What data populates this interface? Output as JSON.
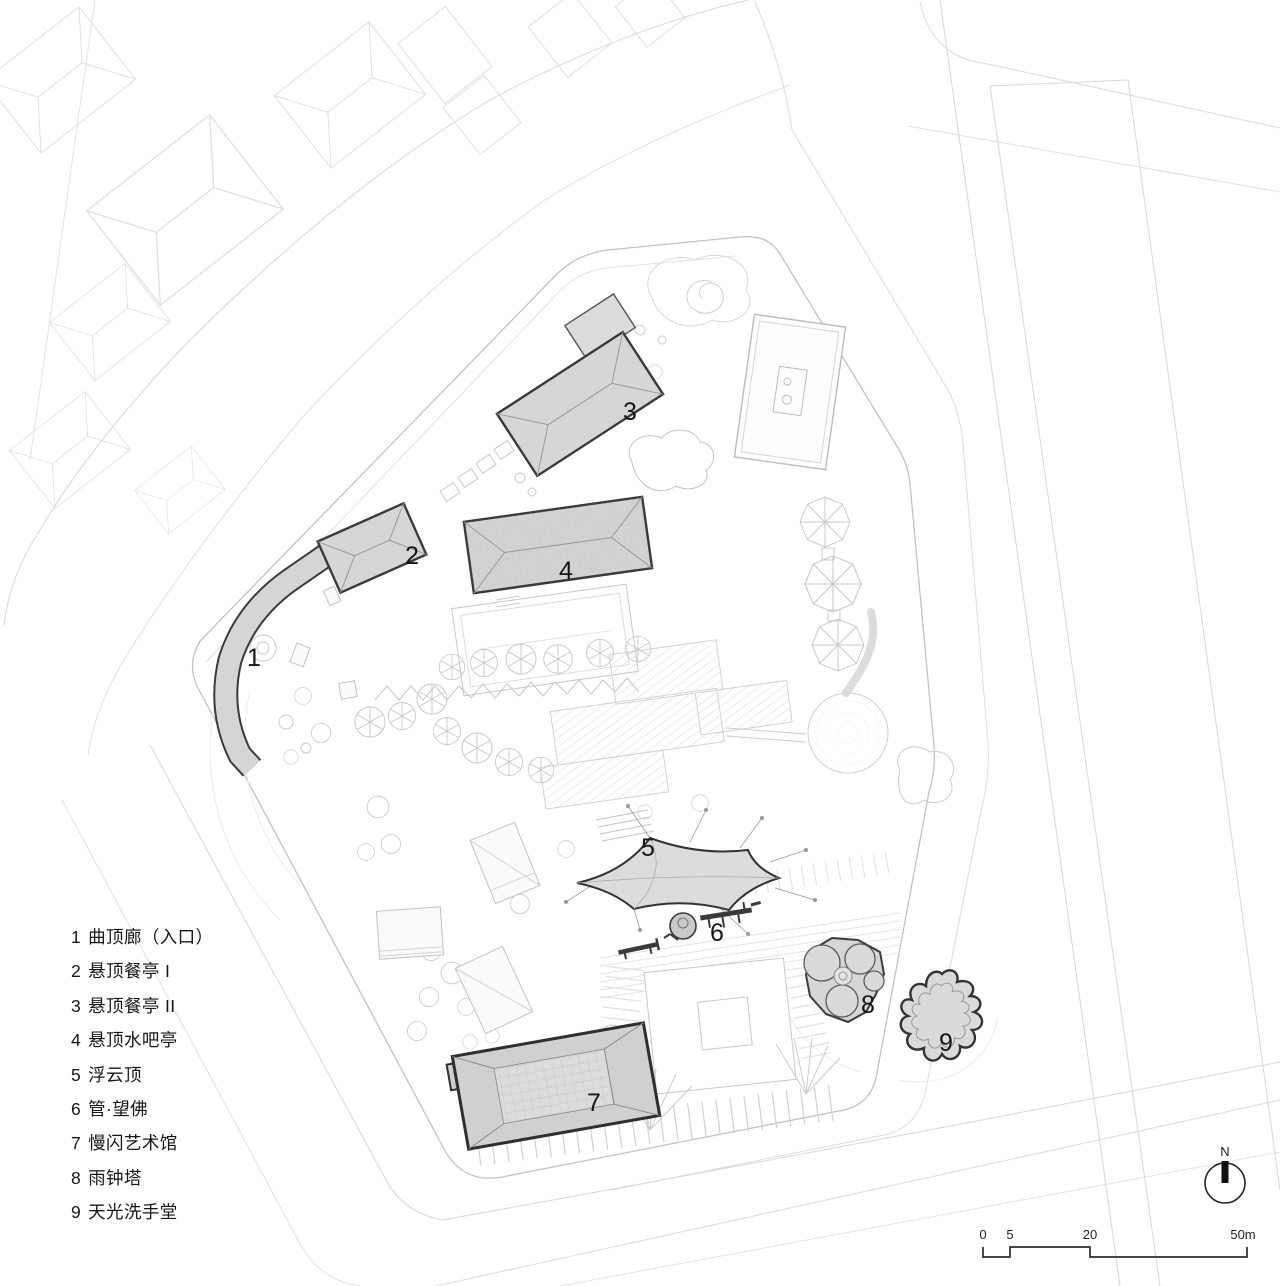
{
  "colors": {
    "background": "#ffffff",
    "context_line": "#dedede",
    "boundary_line": "#c2c2c2",
    "building_fill": "#d6d6d6",
    "building_stroke": "#3a3a3a",
    "label_text": "#151515"
  },
  "legend": {
    "items": [
      {
        "num": "1",
        "label": "曲顶廊（入口）"
      },
      {
        "num": "2",
        "label": "悬顶餐亭 I"
      },
      {
        "num": "3",
        "label": "悬顶餐亭 II"
      },
      {
        "num": "4",
        "label": "悬顶水吧亭"
      },
      {
        "num": "5",
        "label": "浮云顶"
      },
      {
        "num": "6",
        "label": "管·望佛"
      },
      {
        "num": "7",
        "label": "慢闪艺术馆"
      },
      {
        "num": "8",
        "label": "雨钟塔"
      },
      {
        "num": "9",
        "label": "天光洗手堂"
      }
    ]
  },
  "plan_labels": [
    "1",
    "2",
    "3",
    "4",
    "5",
    "6",
    "7",
    "8",
    "9"
  ],
  "north": {
    "label": "N"
  },
  "scale_bar": {
    "ticks": [
      "0",
      "5",
      "20",
      "50m"
    ]
  }
}
